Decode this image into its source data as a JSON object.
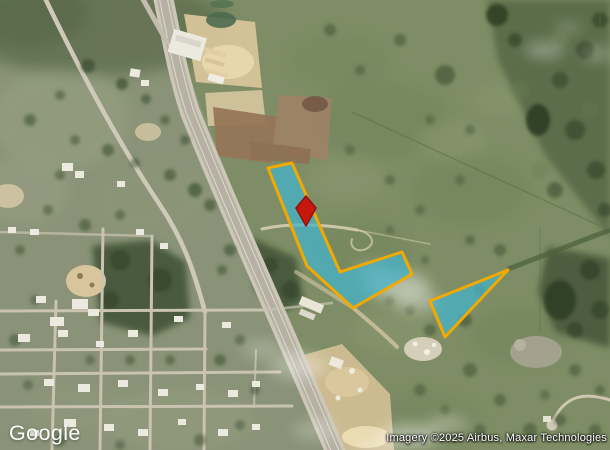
{
  "branding": {
    "logo_text": "Google"
  },
  "attribution": {
    "text": "Imagery ©2025 Airbus, Maxar Technologies"
  },
  "map": {
    "type": "satellite",
    "colors": {
      "parcel_fill": "#46B3C9",
      "parcel_fill_opacity": "0.75",
      "parcel_stroke": "#F2AA00",
      "parcel_stroke_width": "3",
      "pin_fill": "#C8170D",
      "pin_stroke": "#8E120B"
    },
    "parcels": [
      {
        "id": "main-l-shaped-parcel",
        "points": "268,168 292,163 340,272 402,252 412,274 353,308 307,266"
      },
      {
        "id": "triangle-parcel",
        "points": "508,270 430,301 445,337"
      }
    ],
    "pin": {
      "points": "306,196 316,208 306,226 296,208"
    }
  }
}
